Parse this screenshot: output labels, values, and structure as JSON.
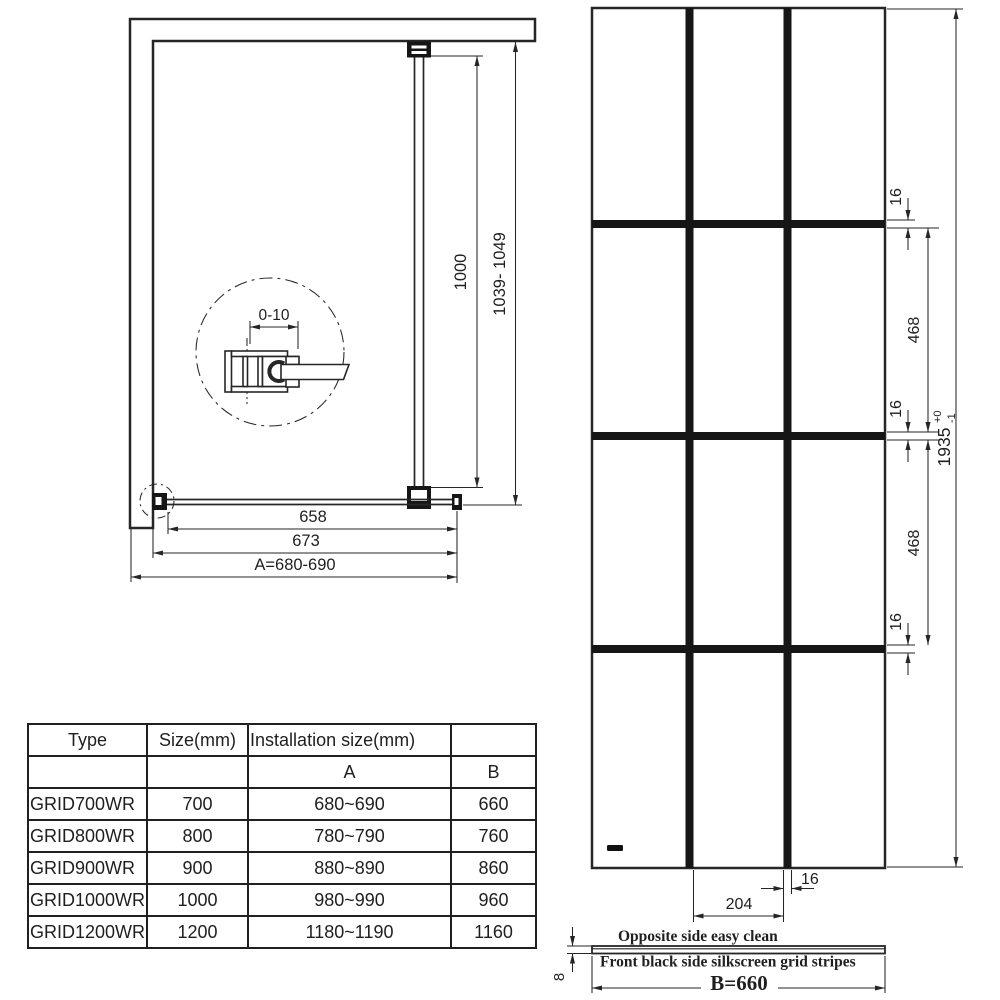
{
  "colors": {
    "line": "#262626",
    "grid_stripe": "#161616",
    "background": "#ffffff"
  },
  "plan_view": {
    "detail_dim": "0-10",
    "dim_inner_width": "658",
    "dim_glass_width": "673",
    "dim_installation_width": "A=680-690",
    "dim_bar_length": "1000",
    "dim_bar_installation": "1039- 1049"
  },
  "front_view": {
    "dim_stripe_top": "16",
    "dim_cell_1": "468",
    "dim_stripe_mid": "16",
    "dim_cell_2": "468",
    "dim_stripe_bottom": "16",
    "dim_height": "1935",
    "dim_height_tol_plus": "+0",
    "dim_height_tol_minus": "-1",
    "dim_cell_width": "204",
    "dim_stripe_width": "16",
    "note_top": "Opposite side easy clean",
    "note_bottom": "Front black side silkscreen grid stripes",
    "dim_glass_width": "B=660",
    "dim_thickness": "8"
  },
  "table": {
    "col_headers": [
      "Type",
      "Size(mm)",
      "Installation size(mm)",
      ""
    ],
    "sub_headers": [
      "",
      "",
      "A",
      "B"
    ],
    "rows": [
      {
        "type": "GRID700WR",
        "size": "700",
        "a": "680~690",
        "b": "660"
      },
      {
        "type": "GRID800WR",
        "size": "800",
        "a": "780~790",
        "b": "760"
      },
      {
        "type": "GRID900WR",
        "size": "900",
        "a": "880~890",
        "b": "860"
      },
      {
        "type": "GRID1000WR",
        "size": "1000",
        "a": "980~990",
        "b": "960"
      },
      {
        "type": "GRID1200WR",
        "size": "1200",
        "a": "1180~1190",
        "b": "1160"
      }
    ]
  }
}
